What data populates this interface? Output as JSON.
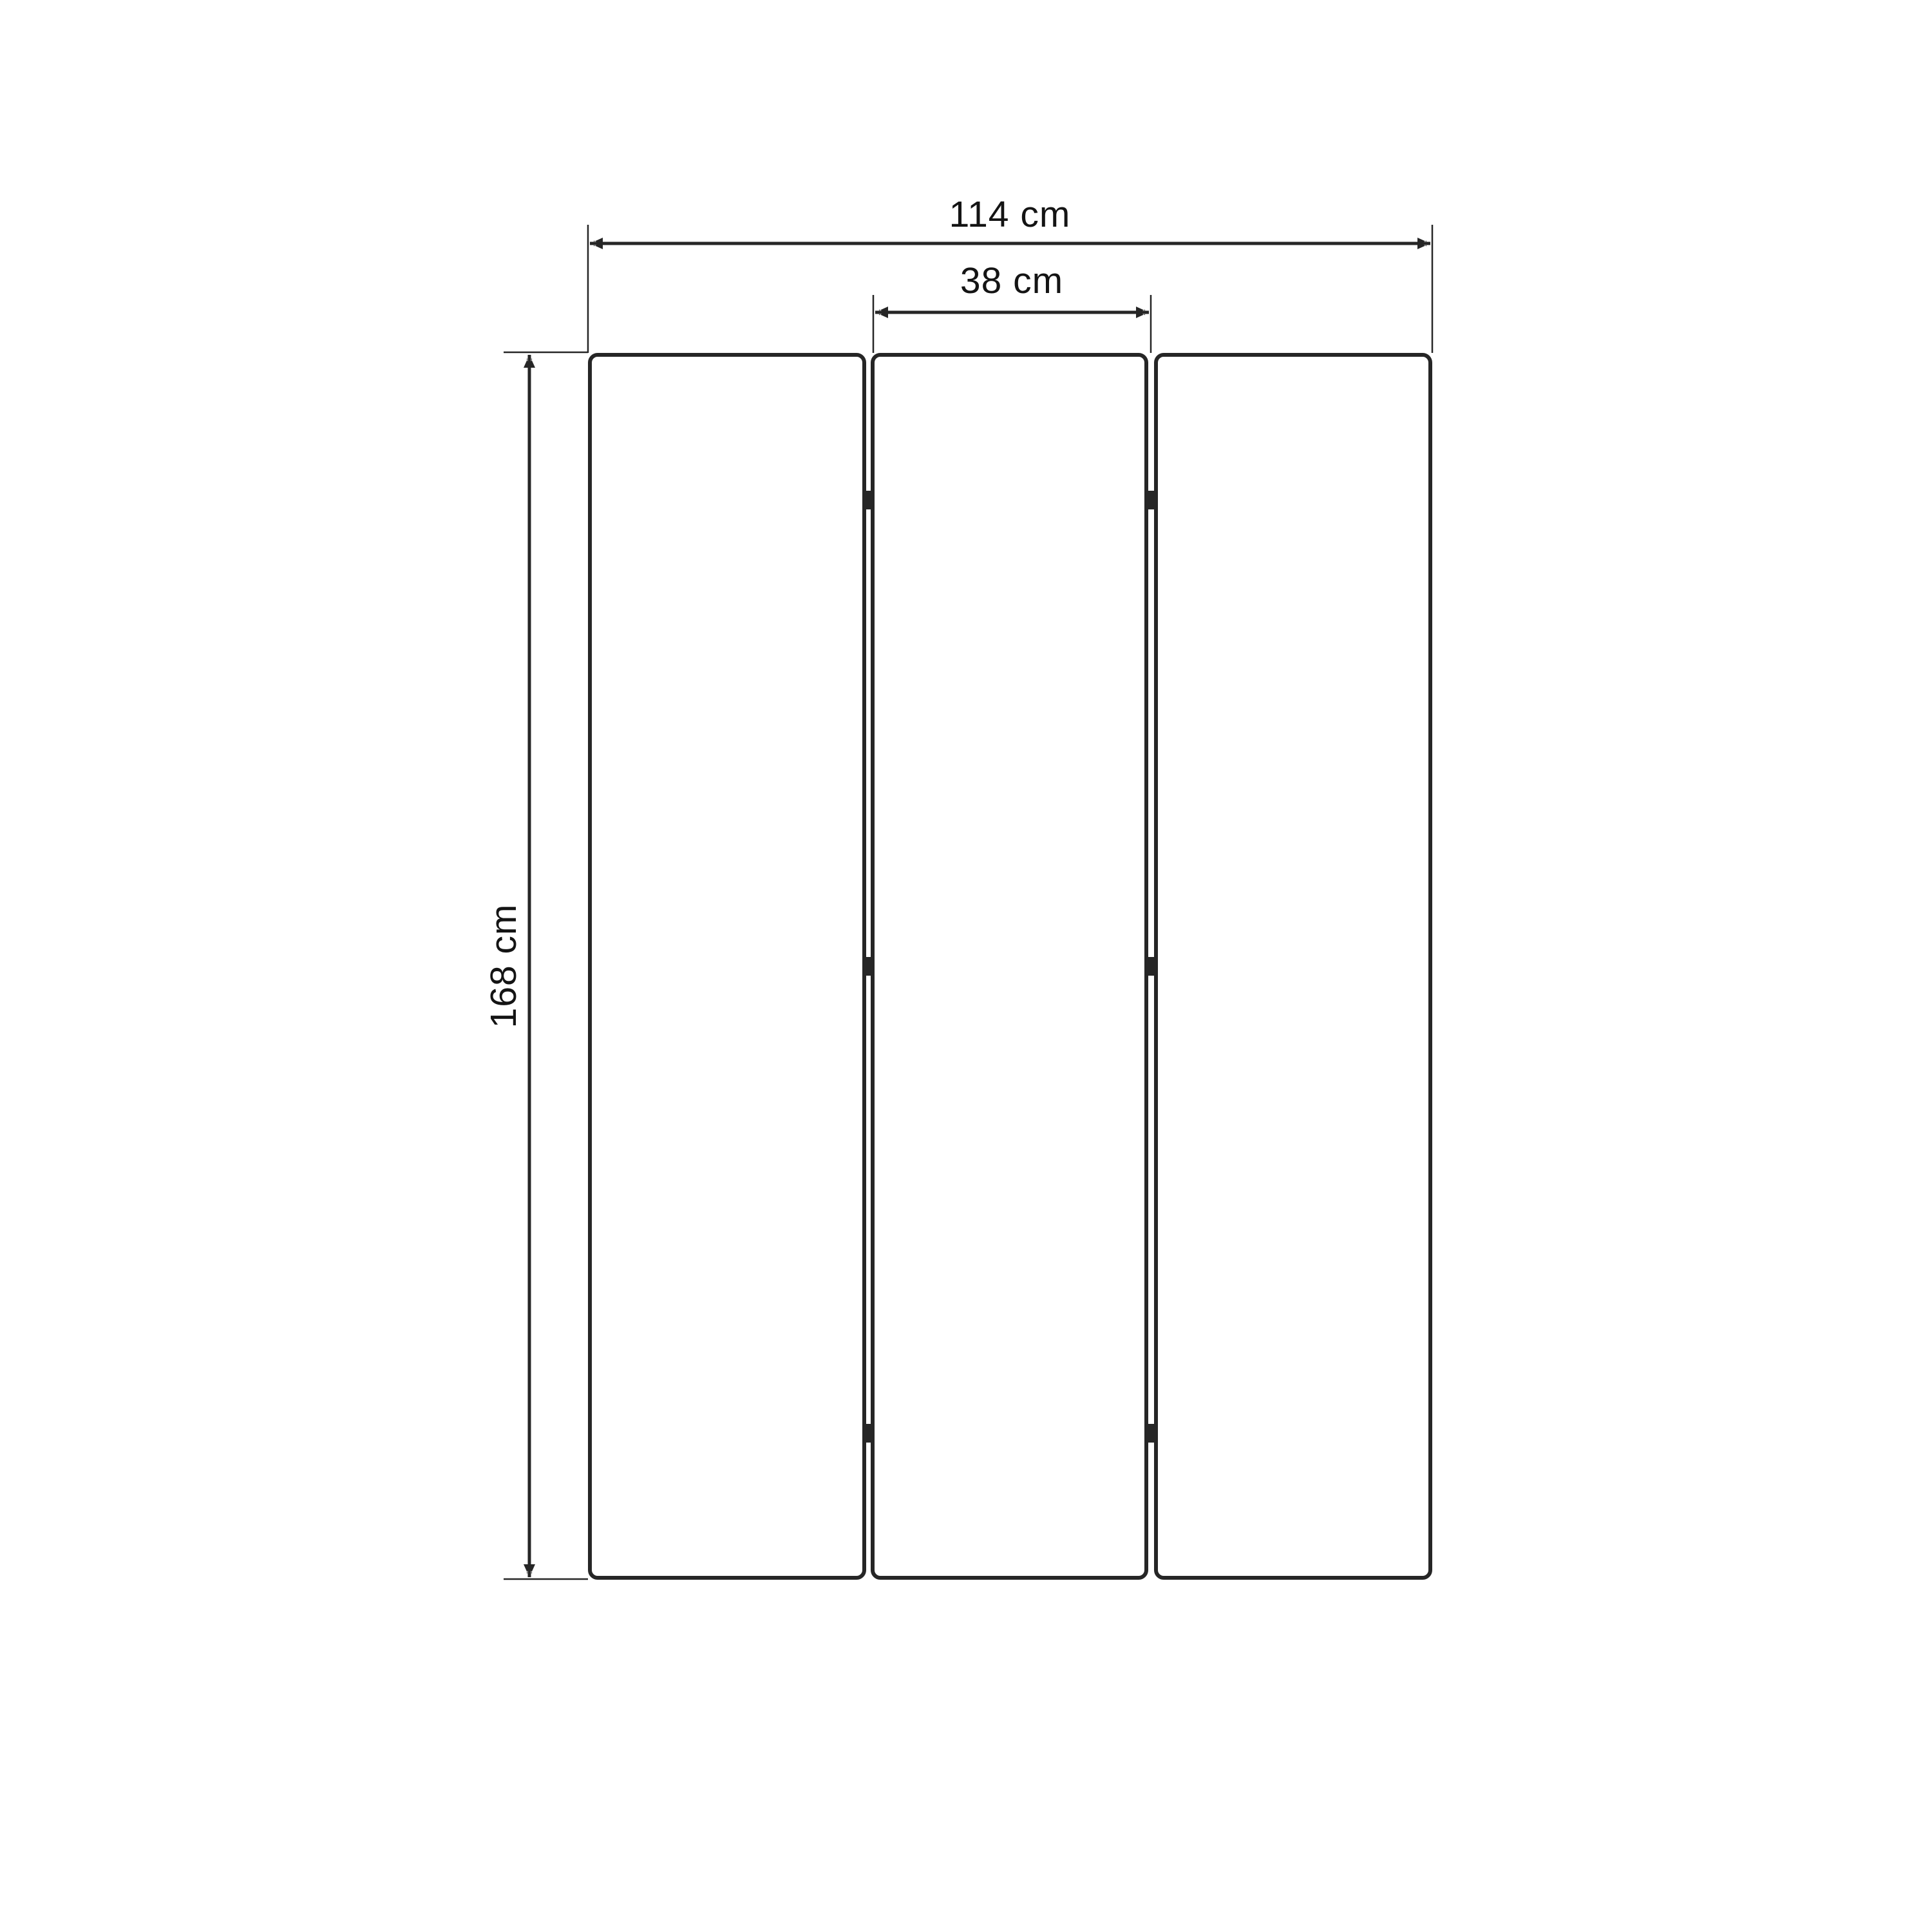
{
  "page": {
    "background_color": "#ffffff"
  },
  "diagram": {
    "object": "three-panel folding screen, front elevation with dimensions",
    "unit": "cm",
    "line_color": "#262626",
    "text_color": "#141414",
    "panel_fill": "#ffffff",
    "panels": {
      "count": 3,
      "hinge_joints": 2,
      "hinge_marks_per_joint": 3
    },
    "dimensions": {
      "total_width": {
        "label": "114 cm",
        "value": 114,
        "orientation": "horizontal"
      },
      "panel_width": {
        "label": "38 cm",
        "value": 38,
        "orientation": "horizontal"
      },
      "height": {
        "label": "168 cm",
        "value": 168,
        "orientation": "vertical"
      }
    }
  }
}
